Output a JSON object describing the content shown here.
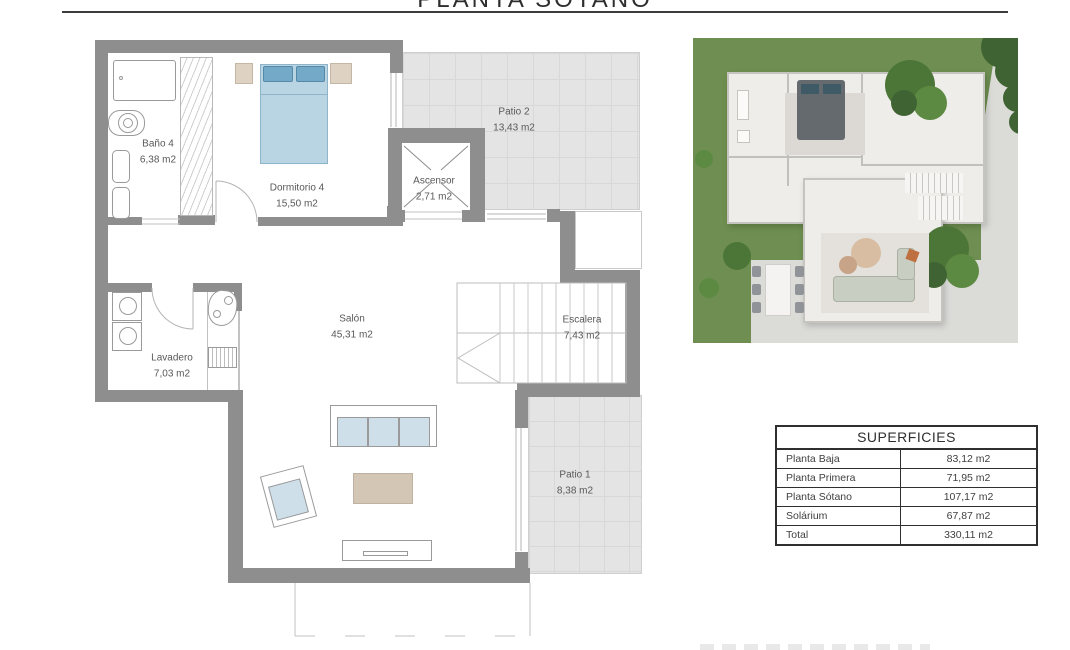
{
  "title": "PLANTA SÓTANO",
  "floorplan": {
    "rooms": [
      {
        "id": "bano4",
        "name": "Baño 4",
        "area": "6,38 m2"
      },
      {
        "id": "dormitorio4",
        "name": "Dormitorio 4",
        "area": "15,50 m2"
      },
      {
        "id": "ascensor",
        "name": "Ascensor",
        "area": "2,71 m2"
      },
      {
        "id": "patio2",
        "name": "Patio 2",
        "area": "13,43 m2"
      },
      {
        "id": "salon",
        "name": "Salón",
        "area": "45,31 m2"
      },
      {
        "id": "escalera",
        "name": "Escalera",
        "area": "7,43 m2"
      },
      {
        "id": "lavadero",
        "name": "Lavadero",
        "area": "7,03 m2"
      },
      {
        "id": "patio1",
        "name": "Patio 1",
        "area": "8,38 m2"
      }
    ]
  },
  "table": {
    "header": "SUPERFICIES",
    "rows": [
      {
        "label": "Planta Baja",
        "value": "83,12 m2"
      },
      {
        "label": "Planta Primera",
        "value": "71,95 m2"
      },
      {
        "label": "Planta Sótano",
        "value": "107,17 m2"
      },
      {
        "label": "Solárium",
        "value": "67,87 m2"
      },
      {
        "label": "Total",
        "value": "330,11 m2"
      }
    ]
  },
  "colors": {
    "wall": "#8e8e8e",
    "patio_tile": "#e4e4e4",
    "bed_blue": "#b9d4e3",
    "pillow_blue": "#74a9c8",
    "nightstand_beige": "#ded3c2",
    "coffee_table": "#d3c6b4",
    "cushion_blue": "#cfdfe9",
    "grass_green": "#6e8f51",
    "table_border": "#2f2f2f"
  }
}
